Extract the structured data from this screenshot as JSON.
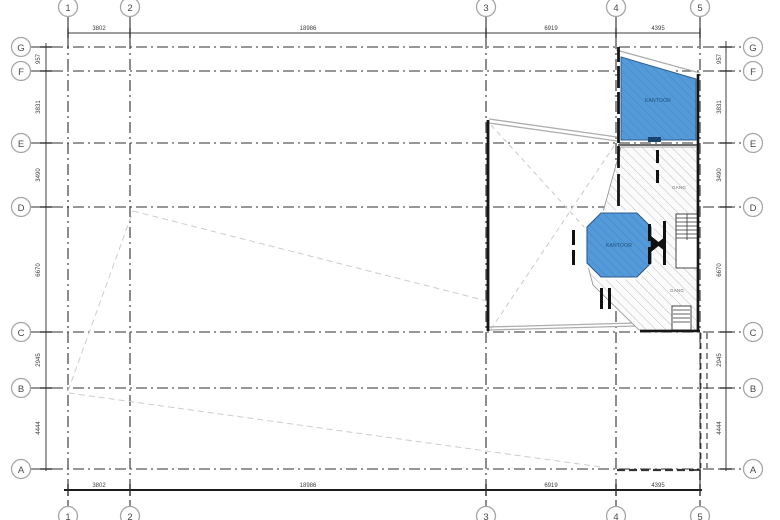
{
  "colors": {
    "room_fill": "#549ad8",
    "room_hatch": "#3d7fc0",
    "room_outline": "#2c5c8f",
    "room_notch": "#17456e",
    "hatch_line": "#bdbdbd",
    "wall": "#161616",
    "grid_line": "#2f2f2f",
    "construction_line": "#cccccc",
    "dim_text": "#3c3c3c",
    "bubble_stroke": "#a6a6a6",
    "bubble_text": "#4a4a4a"
  },
  "grid": {
    "cols": [
      "1",
      "2",
      "3",
      "4",
      "5"
    ],
    "rows": [
      "G",
      "F",
      "E",
      "D",
      "C",
      "B",
      "A"
    ]
  },
  "dimensions": {
    "top": [
      "3802",
      "18986",
      "6919",
      "4395"
    ],
    "bottom": [
      "3802",
      "18986",
      "6919",
      "4395"
    ],
    "left": [
      "957",
      "3831",
      "3490",
      "6670",
      "2945",
      "4444"
    ],
    "right": [
      "957",
      "3831",
      "3490",
      "6670",
      "2945",
      "4444"
    ]
  },
  "rooms": {
    "office_top_label": "KANTOOR",
    "office_octagon_label": "KANTOOR"
  },
  "corridors": {
    "upper_label": "GANG",
    "lower_label": "GANG"
  }
}
